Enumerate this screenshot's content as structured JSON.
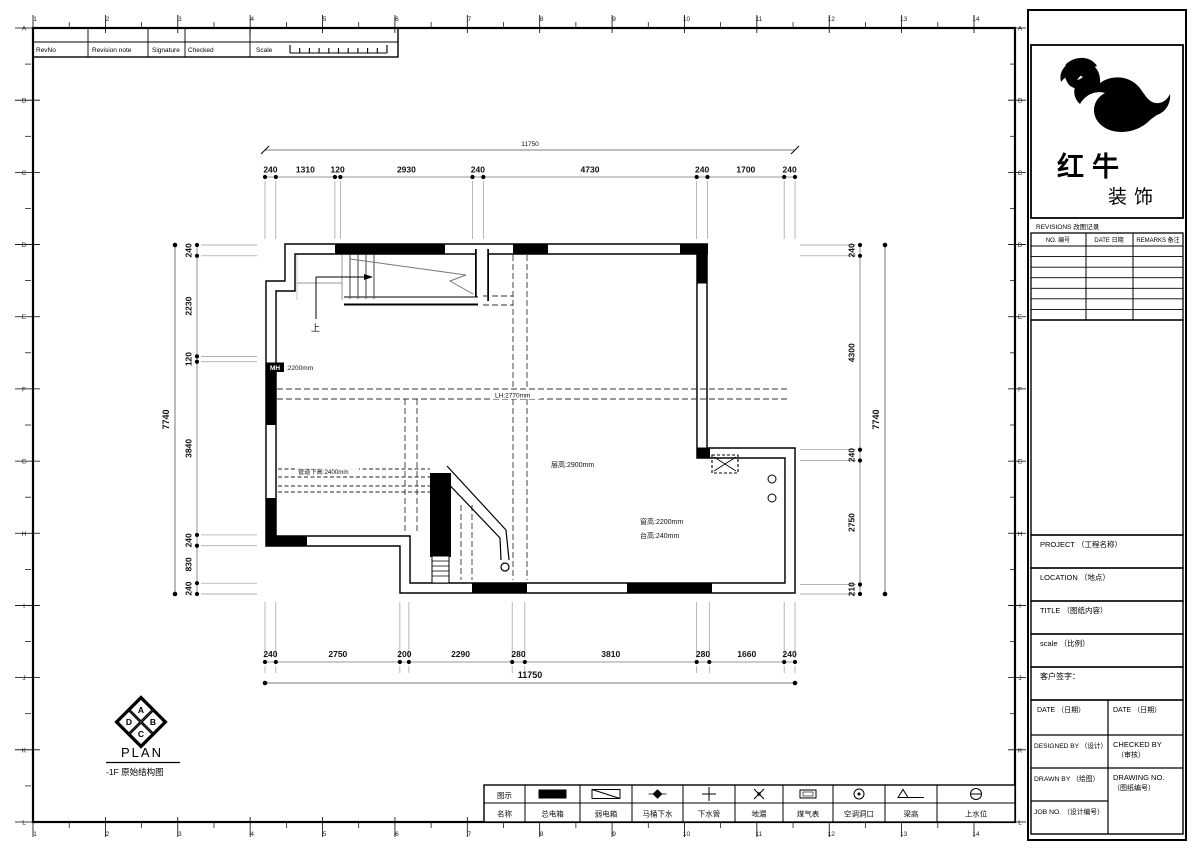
{
  "colors": {
    "ink": "#000000",
    "paper": "#ffffff",
    "thin_line": "#777777"
  },
  "sheet": {
    "grid_cols": [
      "1",
      "2",
      "3",
      "4",
      "5",
      "6",
      "7",
      "8",
      "9",
      "10",
      "11",
      "12",
      "13",
      "14"
    ],
    "grid_rows": [
      "A",
      "B",
      "C",
      "D",
      "E",
      "F",
      "G",
      "H",
      "I",
      "J",
      "K",
      "L"
    ]
  },
  "revision_strip": {
    "rev_no": "RevNo",
    "revision_note": "Revision note",
    "signature": "Signature",
    "checked": "Checked",
    "scale": "Scale"
  },
  "title_block": {
    "brand_name": "红牛",
    "brand_suffix": "装饰",
    "revisions_title": "REVISIONS 改图记录",
    "rev_cols": [
      "NO. 编号",
      "DATE 日期",
      "REMARKS 备注"
    ],
    "rev_empty_rows": 7,
    "project_label": "PROJECT （工程名称）",
    "location_label": "LOCATION （地点）",
    "title_label": "TITLE （图纸内容）",
    "scale_label": "scale （比例）",
    "client_sign_label": "客户签字：",
    "date_label_left": "DATE （日期）",
    "date_label_right": "DATE （日期）",
    "designed_by_label": "DESIGNED BY （设计）",
    "checked_by_label": "CHECKED BY",
    "checked_by_label2": "（审核）",
    "drawn_by_label": "DRAWN BY （绘图）",
    "drawing_no_label": "DRAWING NO.",
    "drawing_no_label2": "（图纸编号）",
    "job_no_label": "JOB NO. （设计编号）"
  },
  "plan": {
    "title": "PLAN",
    "subtitle": "-1F 原始结构图",
    "compass": [
      "A",
      "B",
      "C",
      "D"
    ],
    "labels": {
      "door_tag": "MH",
      "door_value": ":2200mm",
      "beam_height": "LH:2770mm",
      "pipe_height": "管道下高:2400mm",
      "ceiling_height": "层高:2900mm",
      "window_height": "窗高:2200mm",
      "sill_height": "台高:240mm",
      "stair_up": "上"
    },
    "dims": {
      "top": {
        "total": "11750",
        "segments": [
          "240",
          "1310",
          "120",
          "2930",
          "240",
          "4730",
          "240",
          "1700",
          "240"
        ]
      },
      "bottom": {
        "total": "11750",
        "segments": [
          "240",
          "2750",
          "200",
          "2290",
          "280",
          "3810",
          "280",
          "1660",
          "240"
        ]
      },
      "left": {
        "total": "7740",
        "segments": [
          "240",
          "2230",
          "120",
          "3840",
          "240",
          "830",
          "240"
        ]
      },
      "right": {
        "total": "7740",
        "segments": [
          "240",
          "4300",
          "240",
          "2750",
          "210"
        ]
      }
    }
  },
  "legend": {
    "header_symbol": "图示",
    "header_name": "名称",
    "items": [
      {
        "name": "总电箱",
        "symbol": "main-electric-box"
      },
      {
        "name": "弱电箱",
        "symbol": "weak-electric-box"
      },
      {
        "name": "马桶下水",
        "symbol": "toilet-drain"
      },
      {
        "name": "下水管",
        "symbol": "drain-pipe"
      },
      {
        "name": "地漏",
        "symbol": "floor-drain"
      },
      {
        "name": "煤气表",
        "symbol": "gas-meter"
      },
      {
        "name": "空调洞口",
        "symbol": "ac-opening"
      },
      {
        "name": "梁高",
        "symbol": "beam-height"
      },
      {
        "name": "上水位",
        "symbol": "water-supply-level"
      }
    ]
  }
}
